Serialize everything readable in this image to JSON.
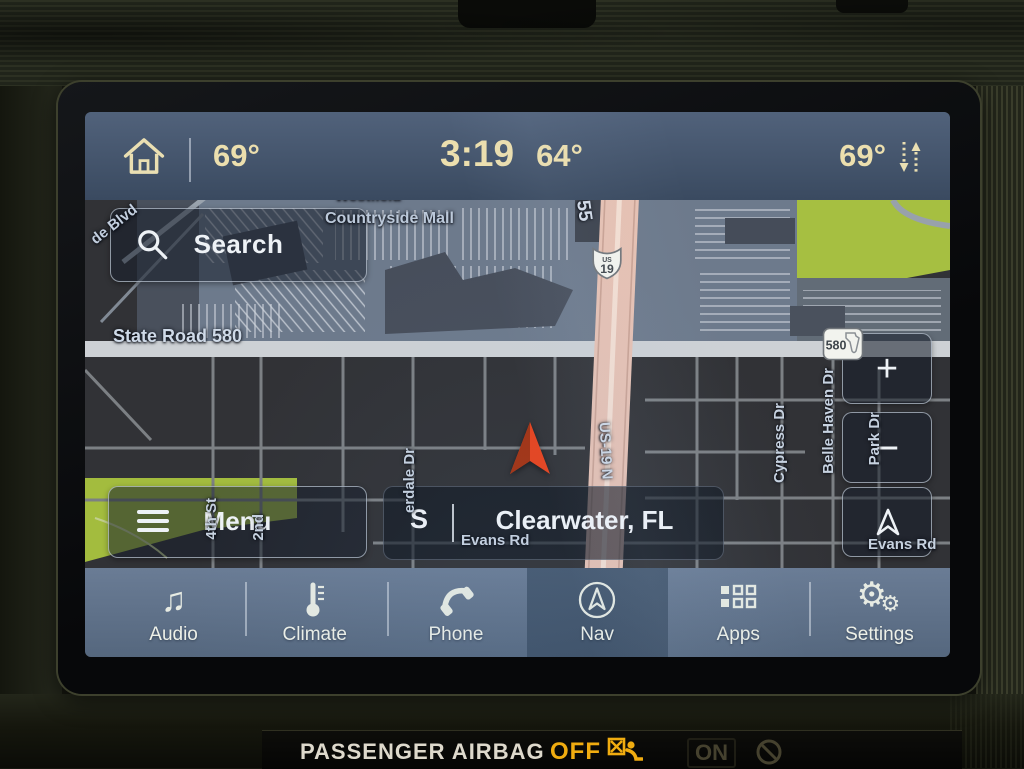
{
  "status_bar": {
    "driver_temp": "69°",
    "clock": "3:19",
    "outside_temp": "64°",
    "passenger_temp": "69°"
  },
  "map": {
    "search_label": "Search",
    "menu_label": "Menu",
    "compass_heading": "S",
    "location": "Clearwater, FL",
    "zoom_in": "+",
    "zoom_out": "−",
    "labels": {
      "westfield": "Westfield",
      "mall": "Countryside Mall",
      "blvd": "de Blvd",
      "sr580": "State Road 580",
      "sr55": "-55",
      "us19_vertical": "US-19 N",
      "cypress": "Cypress Dr",
      "belle_haven": "Belle Haven Dr",
      "park": "Park Dr",
      "evans_right": "Evans Rd",
      "evans_center": "Evans Rd",
      "fourth_st": "4th St",
      "second_st": "2nd",
      "erdale": "erdale Dr"
    },
    "shields": {
      "us19_top": "US",
      "us19_num": "19",
      "sr580_num": "580"
    }
  },
  "nav_bar": {
    "items": [
      {
        "label": "Audio"
      },
      {
        "label": "Climate"
      },
      {
        "label": "Phone"
      },
      {
        "label": "Nav"
      },
      {
        "label": "Apps"
      },
      {
        "label": "Settings"
      }
    ]
  },
  "dashboard": {
    "airbag_label": "PASSENGER AIRBAG",
    "airbag_off": "OFF",
    "airbag_on": "ON"
  },
  "colors": {
    "statusbar_text": "#ecdfae",
    "navbar_blue": "#5d7086",
    "map_green": "#a6bf41",
    "highway_pink": "#e6c1b3",
    "vehicle_arrow_red": "#e8431d",
    "airbag_amber": "#f0ac10"
  }
}
